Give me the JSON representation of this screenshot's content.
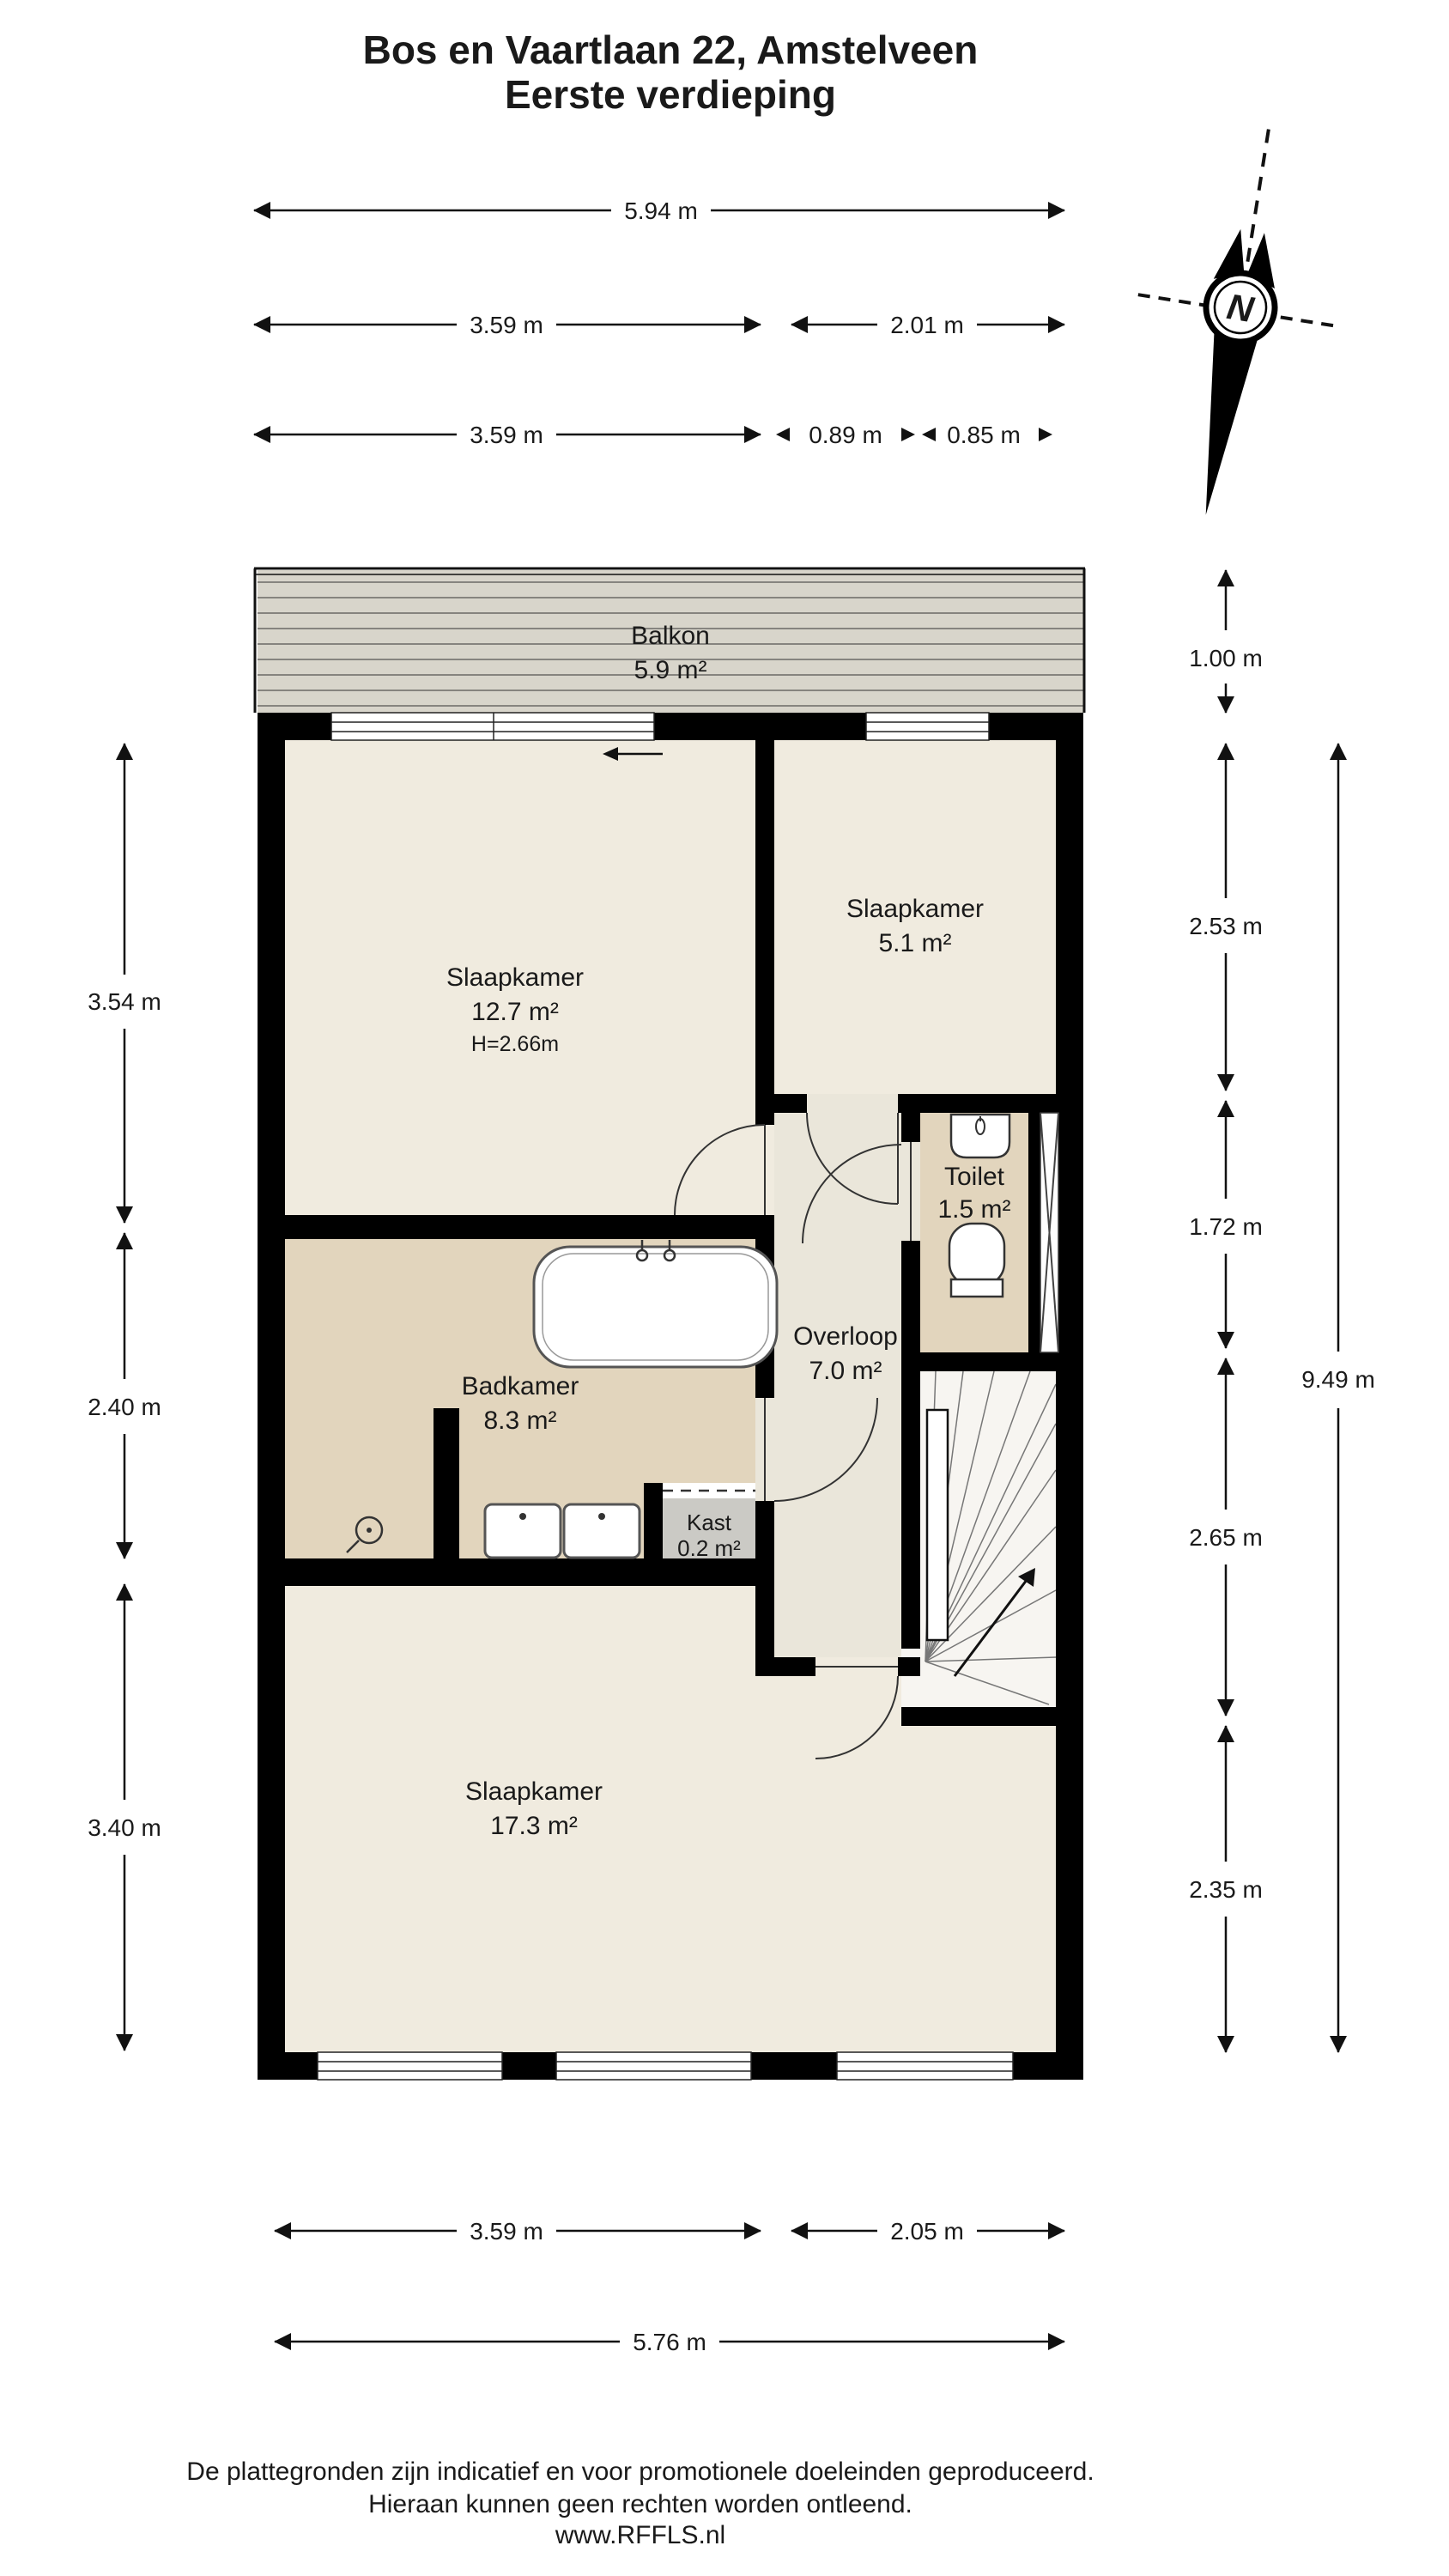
{
  "title": {
    "line1": "Bos en Vaartlaan 22, Amstelveen",
    "line2": "Eerste verdieping"
  },
  "compass": {
    "north_label": "N"
  },
  "rooms": {
    "balcony": {
      "name": "Balkon",
      "area": "5.9 m²"
    },
    "bedroom_front": {
      "name": "Slaapkamer",
      "area": "12.7 m²",
      "ceiling": "H=2.66m"
    },
    "bedroom_small": {
      "name": "Slaapkamer",
      "area": "5.1 m²"
    },
    "toilet": {
      "name": "Toilet",
      "area": "1.5 m²"
    },
    "landing": {
      "name": "Overloop",
      "area": "7.0 m²"
    },
    "bathroom": {
      "name": "Badkamer",
      "area": "8.3 m²"
    },
    "closet": {
      "name": "Kast",
      "area": "0.2 m²"
    },
    "bedroom_back": {
      "name": "Slaapkamer",
      "area": "17.3 m²"
    }
  },
  "dimensions": {
    "top_total": "5.94 m",
    "top_row2": [
      "3.59 m",
      "2.01 m"
    ],
    "top_row3": [
      "3.59 m",
      "0.89 m",
      "0.85 m"
    ],
    "left": [
      "3.54 m",
      "2.40 m",
      "3.40 m"
    ],
    "right": [
      "1.00 m",
      "2.53 m",
      "1.72 m",
      "2.65 m",
      "2.35 m"
    ],
    "right_total": "9.49 m",
    "bottom_row1": [
      "3.59 m",
      "2.05 m"
    ],
    "bottom_total": "5.76 m"
  },
  "footer": {
    "line1": "De plattegronden zijn indicatief en voor promotionele doeleinden geproduceerd.",
    "line2": "Hieraan kunnen geen rechten worden ontleend.",
    "line3": "www.RFFLS.nl"
  },
  "colors": {
    "wall": "#000000",
    "floor_cream": "#f0ebdf",
    "floor_tan": "#e2d5bd",
    "floor_hall": "#eae6da",
    "floor_balcony": "#d8d5cb",
    "floor_closet": "#cbcac5",
    "floor_stairs": "#f7f5f1"
  }
}
